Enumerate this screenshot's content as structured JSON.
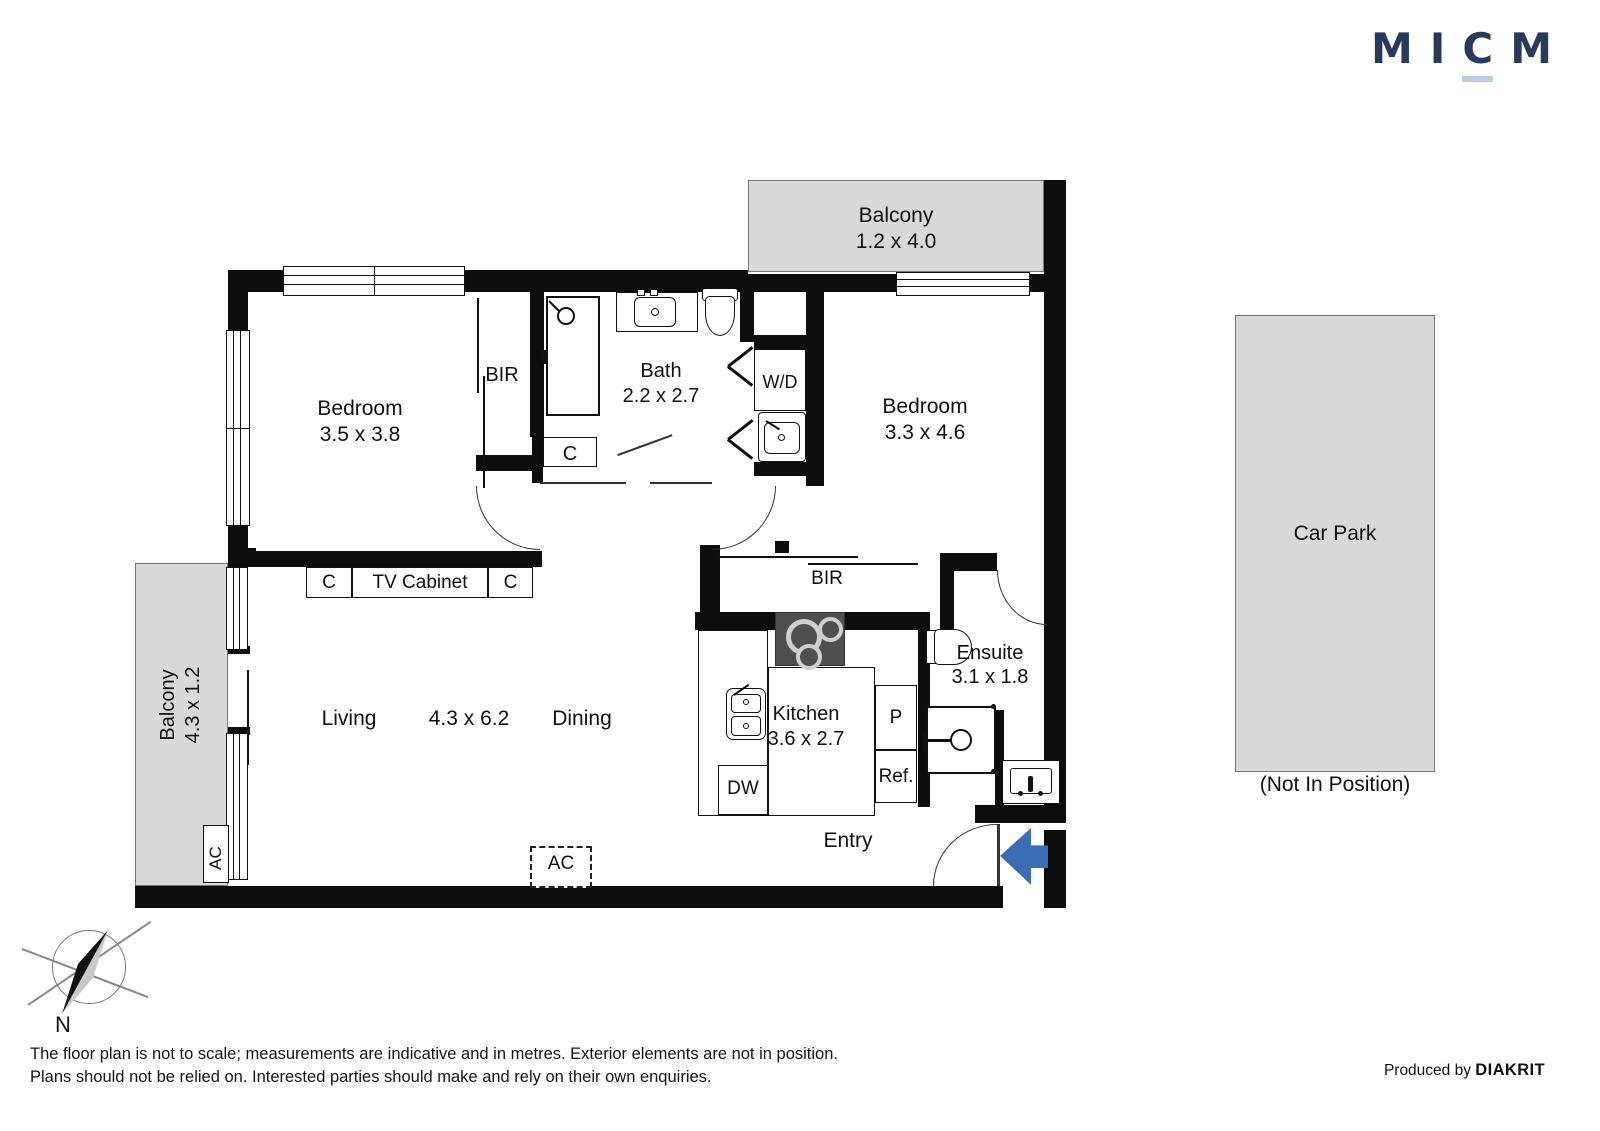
{
  "logo": {
    "letters": [
      "M",
      "I",
      "C",
      "M"
    ]
  },
  "plan": {
    "balcony_top": {
      "name": "Balcony",
      "dims": "1.2 x 4.0"
    },
    "bedroom1": {
      "name": "Bedroom",
      "dims": "3.5 x 3.8"
    },
    "bir1": "BIR",
    "bath": {
      "name": "Bath",
      "dims": "2.2 x 2.7"
    },
    "wd": "W/D",
    "closet": "C",
    "bedroom2": {
      "name": "Bedroom",
      "dims": "3.3 x 4.6"
    },
    "tv_row": {
      "c_left": "C",
      "cabinet": "TV Cabinet",
      "c_right": "C"
    },
    "balcony_left": {
      "name": "Balcony",
      "dims": "4.3 x 1.2"
    },
    "ac_side": "AC",
    "living": "Living",
    "living_dims": "4.3 x 6.2",
    "dining": "Dining",
    "bir2": "BIR",
    "kitchen": {
      "name": "Kitchen",
      "dims": "3.6 x 2.7"
    },
    "dw": "DW",
    "pantry": "P",
    "fridge": "Ref.",
    "ensuite": {
      "name": "Ensuite",
      "dims": "3.1 x 1.8"
    },
    "entry": "Entry",
    "ac_bottom": "AC",
    "carpark": {
      "name": "Car Park",
      "note": "(Not In Position)"
    }
  },
  "compass": {
    "north": "N"
  },
  "footer": {
    "line1": "The floor plan is not to scale; measurements are indicative and in metres. Exterior elements are not in position.",
    "line2": "Plans should not be relied on. Interested parties should make and rely on their own enquiries.",
    "produced_by": "Produced by",
    "brand": "DIAKRIT"
  },
  "colors": {
    "wall": "#0d0d0d",
    "area_fill": "#d9d9d9",
    "logo_navy": "#27395c",
    "logo_underline": "#b9cde8",
    "arrow_blue": "#3a6db3"
  }
}
